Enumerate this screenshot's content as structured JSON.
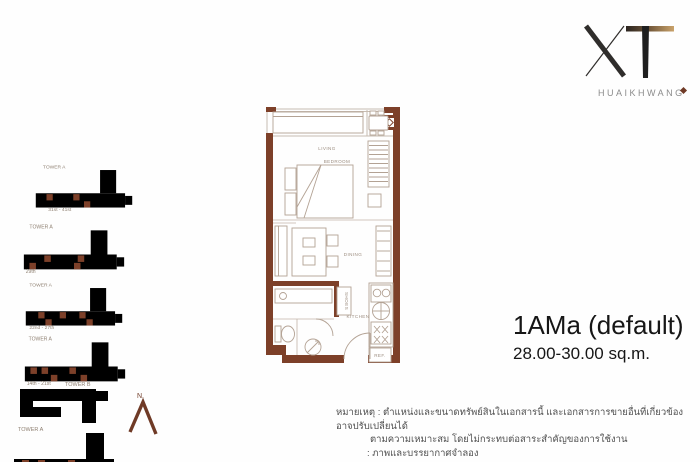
{
  "logo": {
    "brand": "XT",
    "sub": "HUAIKHWANG"
  },
  "keyplans": [
    {
      "tower": "TOWER A",
      "floors": "31st - 41st"
    },
    {
      "tower": "TOWER A",
      "floors": "29th"
    },
    {
      "tower": "TOWER A",
      "floors": "22nd - 27th"
    },
    {
      "tower": "TOWER A",
      "floors": "14th - 21st"
    },
    {
      "towerB": "TOWER B",
      "towerA": "TOWER A"
    }
  ],
  "north": {
    "label": "N."
  },
  "plan": {
    "labels": {
      "living": "LIVING",
      "bedroom": "BEDROOM",
      "dining": "DINING",
      "bathroom": "BATHROOM",
      "shoes": "SHOES",
      "kitchen": "KITCHEN",
      "ref": "REF."
    }
  },
  "unit": {
    "name": "1AMa (default)",
    "area": "28.00-30.00 sq.m."
  },
  "remark": {
    "line1": "หมายเหตุ : ตำแหน่งและขนาดทรัพย์สินในเอกสารนี้ และเอกสารการขายอื่นที่เกี่ยวข้อง อาจปรับเปลี่ยนได้",
    "line2": "ตามความเหมาะสม โดยไม่กระทบต่อสาระสำคัญของการใช้งาน",
    "line3": ": ภาพและบรรยากาศจำลอง"
  },
  "colors": {
    "wall": "#7d4029",
    "gold": "#caa36b"
  }
}
